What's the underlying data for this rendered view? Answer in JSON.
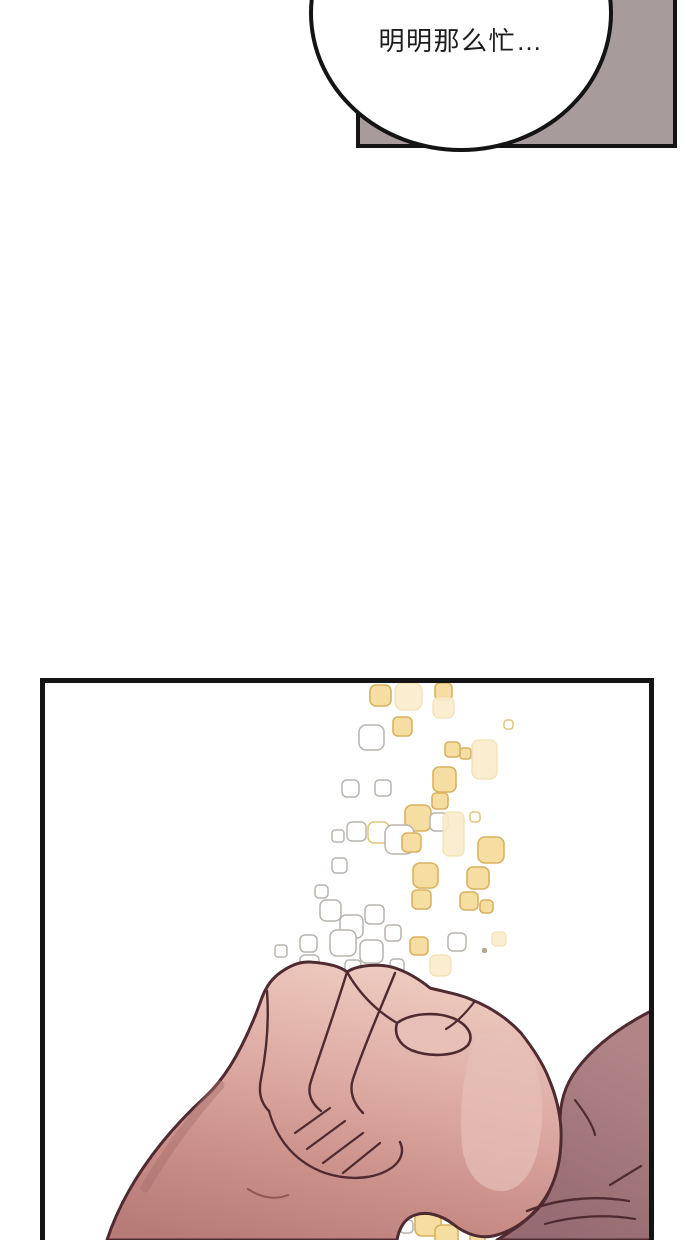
{
  "speech_bubble": {
    "text": "明明那么忙…"
  },
  "colors": {
    "page-bg": "#ffffff",
    "ink": "#141414",
    "panel-gray": "#a89b9b",
    "outline-maroon": "#4f2b31",
    "skin-light": "#eecabf",
    "skin-mid": "#d8a49d",
    "skin-deep": "#bb7f7a",
    "forearm-dark": "#9d7176",
    "hand-highlight": "#e7c0b8",
    "sparkle-yellow": "#f6dda1",
    "sparkle-yellow-outline": "#d9b25f",
    "sparkle-gray-outline": "#b8b4ae"
  },
  "particle_styles": {
    "y": {
      "fill": "#f6dda1",
      "stroke": "#d9b25f",
      "sw": 1.6
    },
    "p": {
      "fill": "#faeccb",
      "stroke": "#f1ddab",
      "sw": 1.2,
      "opacity": 0.9
    },
    "g": {
      "fill": "#ffffff",
      "stroke": "#b8b4ae",
      "sw": 1.5
    },
    "w": {
      "fill": "#ffffff",
      "stroke": "#e2c57d",
      "sw": 1.5
    },
    "d": {
      "fill": "#b3a78e",
      "sw": 0
    }
  },
  "particles": [
    {
      "x": 325,
      "y": 2,
      "s": 21,
      "t": "y"
    },
    {
      "x": 350,
      "y": 0,
      "s": 27,
      "t": "p"
    },
    {
      "x": 390,
      "y": 0,
      "s": 17,
      "t": "y"
    },
    {
      "x": 388,
      "y": 14,
      "s": 21,
      "t": "p"
    },
    {
      "x": 459,
      "y": 37,
      "s": 9,
      "t": "w"
    },
    {
      "x": 314,
      "y": 42,
      "s": 25,
      "t": "g"
    },
    {
      "x": 348,
      "y": 34,
      "s": 19,
      "t": "y"
    },
    {
      "x": 400,
      "y": 59,
      "s": 15,
      "t": "y"
    },
    {
      "x": 415,
      "y": 65,
      "s": 11,
      "t": "y"
    },
    {
      "x": 427,
      "y": 57,
      "s": 25,
      "h": 39,
      "t": "p"
    },
    {
      "x": 388,
      "y": 84,
      "s": 23,
      "h": 25,
      "t": "y"
    },
    {
      "x": 297,
      "y": 97,
      "s": 17,
      "t": "g"
    },
    {
      "x": 330,
      "y": 97,
      "s": 16,
      "t": "g"
    },
    {
      "x": 387,
      "y": 110,
      "s": 16,
      "t": "y"
    },
    {
      "x": 425,
      "y": 129,
      "s": 10,
      "t": "w"
    },
    {
      "x": 360,
      "y": 122,
      "s": 26,
      "t": "y"
    },
    {
      "x": 385,
      "y": 130,
      "s": 18,
      "t": "g"
    },
    {
      "x": 398,
      "y": 129,
      "s": 21,
      "h": 44,
      "t": "p"
    },
    {
      "x": 287,
      "y": 147,
      "s": 12,
      "t": "g"
    },
    {
      "x": 302,
      "y": 139,
      "s": 19,
      "t": "g"
    },
    {
      "x": 323,
      "y": 139,
      "s": 21,
      "t": "w"
    },
    {
      "x": 340,
      "y": 142,
      "s": 29,
      "t": "g"
    },
    {
      "x": 357,
      "y": 150,
      "s": 19,
      "t": "y"
    },
    {
      "x": 433,
      "y": 154,
      "s": 26,
      "t": "y"
    },
    {
      "x": 287,
      "y": 175,
      "s": 15,
      "t": "g"
    },
    {
      "x": 368,
      "y": 180,
      "s": 25,
      "t": "y"
    },
    {
      "x": 422,
      "y": 184,
      "s": 22,
      "t": "y"
    },
    {
      "x": 270,
      "y": 202,
      "s": 13,
      "t": "g"
    },
    {
      "x": 367,
      "y": 207,
      "s": 19,
      "t": "y"
    },
    {
      "x": 415,
      "y": 209,
      "s": 18,
      "t": "y"
    },
    {
      "x": 435,
      "y": 217,
      "s": 13,
      "t": "y"
    },
    {
      "x": 275,
      "y": 217,
      "s": 21,
      "t": "g"
    },
    {
      "x": 295,
      "y": 232,
      "s": 23,
      "t": "g"
    },
    {
      "x": 320,
      "y": 222,
      "s": 19,
      "t": "g"
    },
    {
      "x": 255,
      "y": 252,
      "s": 17,
      "t": "g"
    },
    {
      "x": 285,
      "y": 247,
      "s": 26,
      "t": "g"
    },
    {
      "x": 315,
      "y": 257,
      "s": 23,
      "t": "g"
    },
    {
      "x": 340,
      "y": 242,
      "s": 16,
      "t": "g"
    },
    {
      "x": 365,
      "y": 254,
      "s": 18,
      "t": "y"
    },
    {
      "x": 385,
      "y": 272,
      "s": 21,
      "t": "p"
    },
    {
      "x": 403,
      "y": 250,
      "s": 18,
      "t": "g"
    },
    {
      "x": 447,
      "y": 249,
      "s": 14,
      "t": "p"
    },
    {
      "x": 437,
      "y": 265,
      "s": 5,
      "t": "d"
    },
    {
      "x": 255,
      "y": 272,
      "s": 19,
      "t": "g"
    },
    {
      "x": 300,
      "y": 277,
      "s": 16,
      "t": "g"
    },
    {
      "x": 230,
      "y": 262,
      "s": 12,
      "t": "g"
    },
    {
      "x": 345,
      "y": 276,
      "s": 14,
      "t": "g"
    },
    {
      "x": 370,
      "y": 527,
      "s": 26,
      "t": "y"
    },
    {
      "x": 395,
      "y": 512,
      "s": 19,
      "t": "p"
    },
    {
      "x": 390,
      "y": 542,
      "s": 23,
      "t": "y"
    },
    {
      "x": 415,
      "y": 532,
      "s": 17,
      "t": "w"
    },
    {
      "x": 425,
      "y": 547,
      "s": 15,
      "t": "y"
    },
    {
      "x": 355,
      "y": 537,
      "s": 13,
      "t": "g"
    },
    {
      "x": 440,
      "y": 520,
      "s": 12,
      "t": "p"
    }
  ]
}
